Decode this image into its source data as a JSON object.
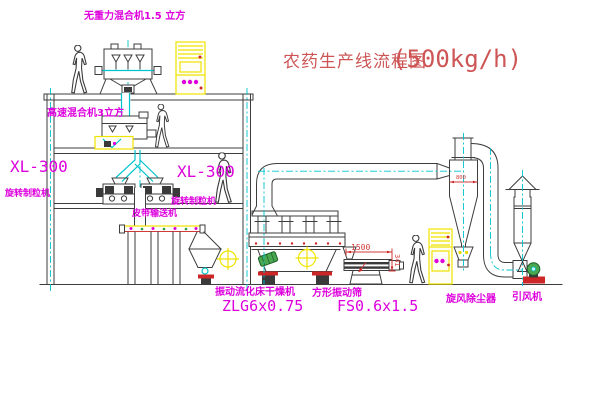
{
  "title": {
    "main": "农药生产线流程图",
    "capacity": "(500kg/h)"
  },
  "equipment": {
    "top_mixer": "无重力混合机1.5 立方",
    "floor2_mixer": "高速混合机3立方",
    "granulator_left": {
      "model": "XL-300",
      "name": "旋转制粒机"
    },
    "granulator_right": {
      "model": "XL-300",
      "name": "旋转制粒机"
    },
    "belt_conveyor": "皮带输送机",
    "dryer": {
      "name": "振动流化床干燥机",
      "model": "ZLG6x0.75"
    },
    "screen": {
      "name": "方形振动筛",
      "model": "FS0.6x1.5"
    },
    "cyclone": "旋风除尘器",
    "fan": "引风机"
  },
  "dimensions": {
    "screen_length": "1500",
    "screen_height": "341",
    "cyclone_dim": "800"
  },
  "colors": {
    "background": "#ffffff",
    "line": "#3d3d3d",
    "centerline_cyan": "#00c3cc",
    "cabinet_yellow": "#efe400",
    "label_magenta": "#dd00dd",
    "dimension_red": "#d23a3a",
    "title_red": "#cd5555",
    "motor_green": "#49a84f"
  }
}
